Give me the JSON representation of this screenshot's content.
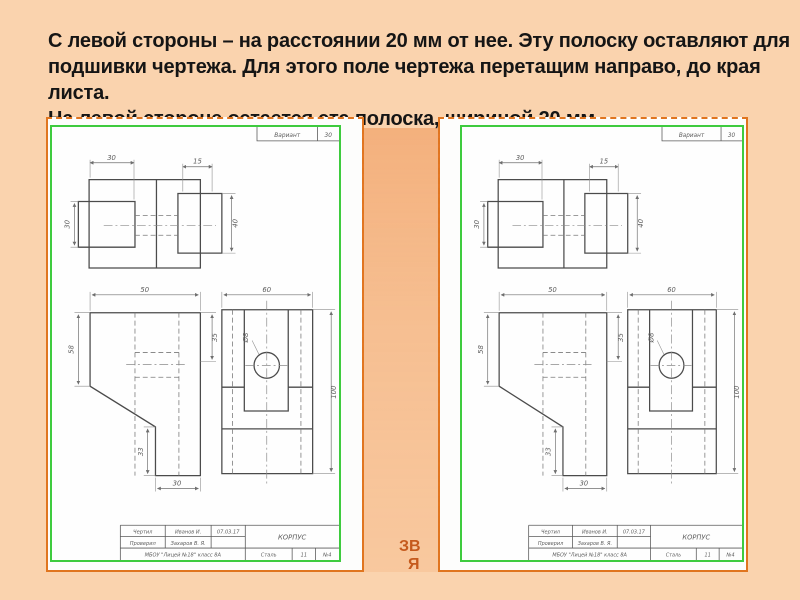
{
  "slide": {
    "background": "#fad3ae",
    "accent_orange": "#e0751f",
    "frame_green": "#3ecb3e"
  },
  "text": {
    "lines": [
      "С левой стороны – на расстоянии 20 мм от  нее. Эту полоску оставляют для",
      "подшивки чертежа. Для этого поле чертежа перетащим направо, до края",
      "листа.",
      "На левой стороне остается эта полоска, шириной 20 мм"
    ]
  },
  "stray": {
    "line1": "ЗВ",
    "line2": "Я"
  },
  "variant": {
    "label": "Вариант",
    "value": "30"
  },
  "title_block": {
    "row1_label": "Чертил",
    "row1_name": "Иванов И.",
    "row1_date": "07.03.17",
    "row2_label": "Проверил",
    "row2_name": "Захаров В. Я.",
    "school": "МБОУ \"Лицей №18\" класс 8А",
    "part_name": "КОРПУС",
    "material": "Сталь",
    "col2": "11",
    "col3": "№4"
  },
  "dims": {
    "plan_width": "30",
    "plan_boss": "15",
    "plan_left_height": "30",
    "plan_right_height": "40",
    "front_width": "50",
    "front_height": "58",
    "front_right": "35",
    "front_step": "33",
    "front_foot": "30",
    "side_width": "60",
    "side_height": "100",
    "hole_diameter": "Ø8"
  }
}
